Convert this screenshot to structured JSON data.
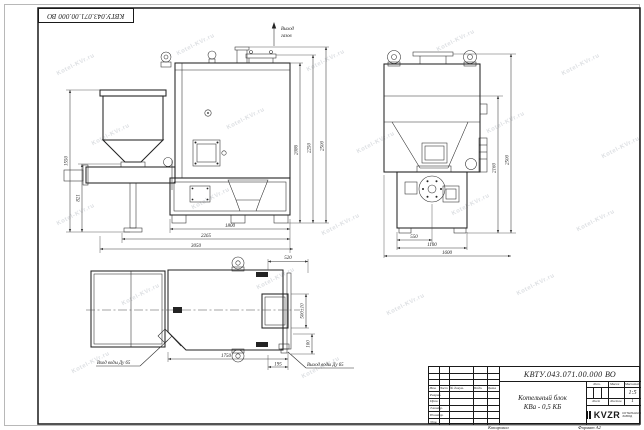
{
  "sheet": {
    "doc_number": "КВТУ.043.071.00.000 ВО",
    "copied_label": "Копировал",
    "format_label": "Формат А2",
    "watermark": "Kotel-KVr.ru"
  },
  "title_block": {
    "doc_number": "КВТУ.043.071.00.000 ВО",
    "title_line1": "Котельный блок",
    "title_line2": "КВа - 0,5 КБ",
    "header_cols": [
      "Изм.",
      "Лист",
      "№ докум.",
      "Подп.",
      "Дата"
    ],
    "row_labels": [
      "Разраб.",
      "Пров.",
      "Т.контр.",
      "Н.контр.",
      "Утв."
    ],
    "lit_label": "Лит.",
    "mass_label": "Масса",
    "scale_label": "Масштаб",
    "scale_value": "1:5",
    "sheet_label": "Лист",
    "sheets_label": "Листов",
    "sheets_value": "1",
    "logo_text": "KVZR",
    "logo_sub1": "КОТЕЛЬНЫЙ",
    "logo_sub2": "ЗАВОД"
  },
  "front": {
    "gas_outlet_line1": "Выход",
    "gas_outlet_line2": "газов",
    "dim_left_total": "1550",
    "dim_left_auger": "821",
    "dim_right_1": "2086",
    "dim_right_2": "2250",
    "dim_right_3": "2500",
    "dim_bottom_1": "1800",
    "dim_bottom_2": "2265",
    "dim_bottom_3": "3050"
  },
  "side": {
    "dim_right_1": "2160",
    "dim_right_2": "2500",
    "dim_bottom_1": "550",
    "dim_bottom_2": "1100",
    "dim_bottom_3": "1600"
  },
  "plan": {
    "water_inlet": "Вход воды Ду 65",
    "water_outlet": "Выход воды Ду 65",
    "dim_top": "520",
    "dim_opening": "500±10",
    "dim_right": "100",
    "dim_bottom_1": "1750",
    "dim_bottom_2": "195"
  }
}
